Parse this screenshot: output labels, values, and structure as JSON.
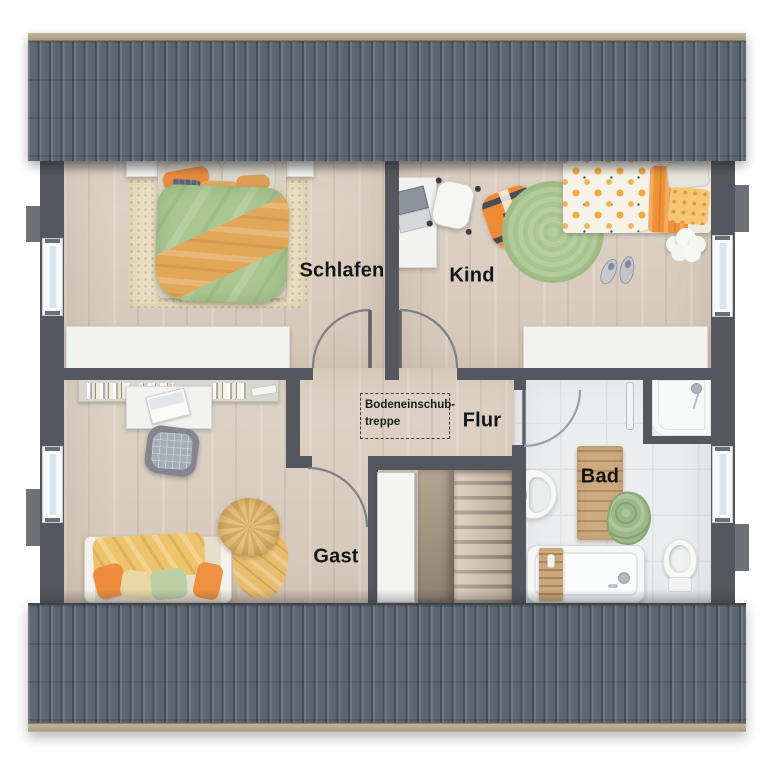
{
  "rooms": {
    "schlafen": "Schlafen",
    "kind": "Kind",
    "flur": "Flur",
    "gast": "Gast",
    "bad": "Bad"
  },
  "annotations": {
    "attic_stairs_line1": "Bodeneinschub-",
    "attic_stairs_line2": "treppe"
  },
  "palette": {
    "roof": "#5d6571",
    "roof_ridge": "#b5a68e",
    "wall": "#54575d",
    "wood_floor": "#dbcfc1",
    "bath_tile": "#ecedee",
    "accent_orange": "#ee8c3a",
    "accent_green": "#a9c690",
    "accent_yellow": "#ecc26e",
    "label_text": "#151515"
  }
}
